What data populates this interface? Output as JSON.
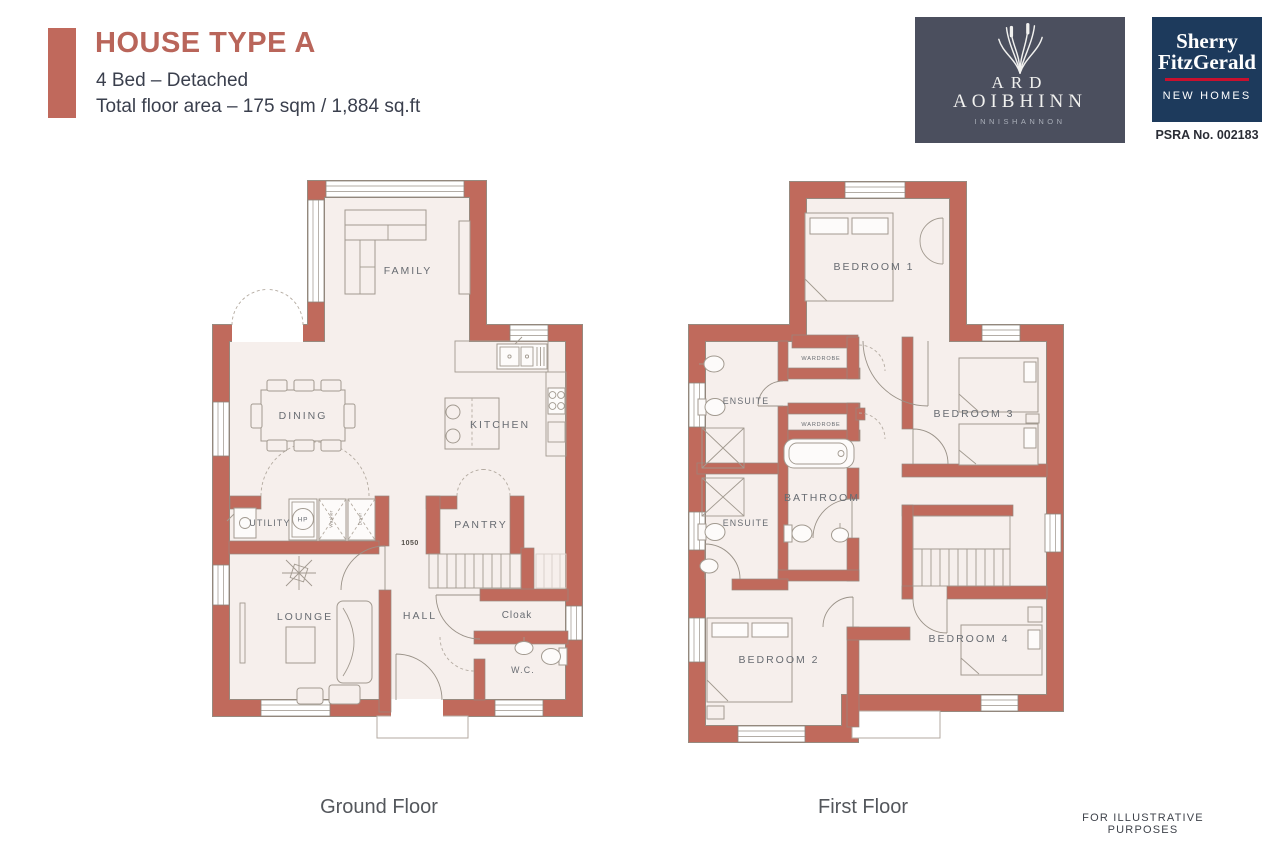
{
  "header": {
    "title": "HOUSE TYPE A",
    "subtitle1": "4 Bed – Detached",
    "subtitle2": "Total floor area – 175 sqm / 1,884 sq.ft"
  },
  "logos": {
    "ard": {
      "line1": "ARD",
      "line2": "AOIBHINN",
      "location": "INNISHANNON"
    },
    "sherry": {
      "line1": "Sherry",
      "line2": "FitzGerald",
      "division": "NEW HOMES",
      "psra": "PSRA No. 002183"
    }
  },
  "ground_floor": {
    "caption": "Ground Floor",
    "rooms": {
      "family": "FAMILY",
      "dining": "DINING",
      "kitchen": "KITCHEN",
      "utility": "UTILITY",
      "pantry": "PANTRY",
      "lounge": "LOUNGE",
      "hall": "HALL",
      "cloak": "Cloak",
      "wc": "W.C.",
      "hp": "HP",
      "stairs_dim": "1050",
      "washer": "Washer",
      "dryer": "Dryer"
    }
  },
  "first_floor": {
    "caption": "First Floor",
    "rooms": {
      "bedroom1": "BEDROOM 1",
      "bedroom2": "BEDROOM 2",
      "bedroom3": "BEDROOM 3",
      "bedroom4": "BEDROOM 4",
      "bathroom": "BATHROOM",
      "ensuite_top": "ENSUITE",
      "ensuite_bottom": "ENSUITE",
      "wardrobe_top": "WARDROBE",
      "wardrobe_bottom": "WARDROBE"
    }
  },
  "footer": {
    "disclaimer": "FOR ILLUSTRATIVE PURPOSES"
  },
  "colors": {
    "wall": "#c06a5c",
    "floor": "#f6efec",
    "title": "#b9655a",
    "heading_text": "#3a3f4d",
    "ard_logo_bg": "#4b4f5e",
    "sherry_bg": "#1d3a5c",
    "sherry_red": "#c8102e",
    "label_text": "#686c72"
  }
}
